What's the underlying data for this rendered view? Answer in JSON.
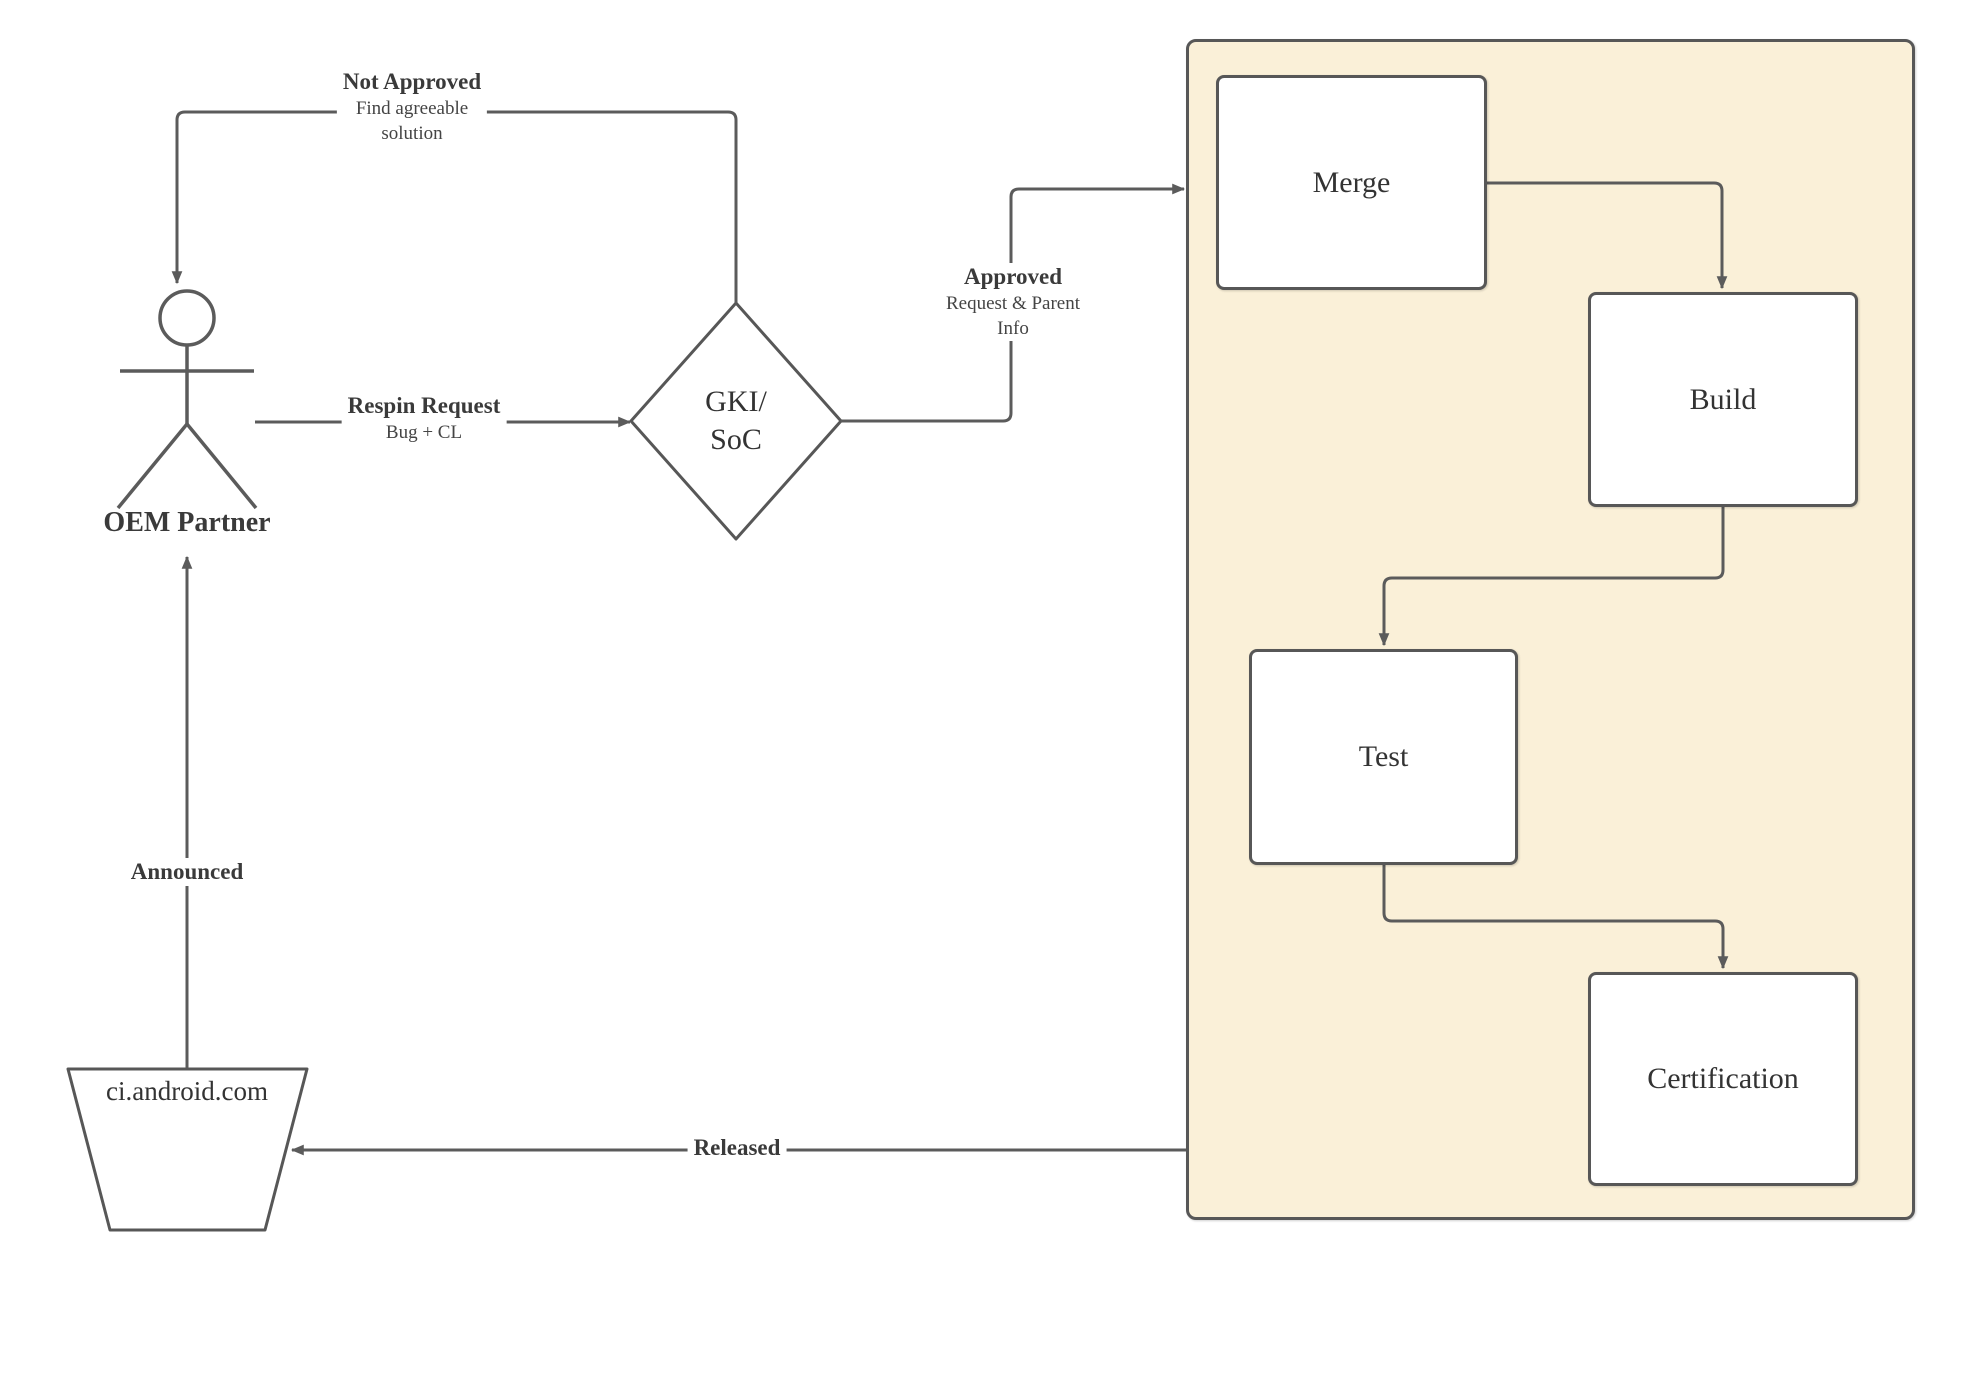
{
  "diagram": {
    "type": "flowchart",
    "background_color": "#ffffff",
    "line_color": "#5b5b5b",
    "text_color": "#363636",
    "actor": {
      "label": "OEM Partner"
    },
    "decision": {
      "line1": "GKI/",
      "line2": "SoC"
    },
    "datastore": {
      "label": "ci.android.com"
    },
    "container": {
      "fill_color": "#faf0d8",
      "border_color": "#575757",
      "nodes": {
        "merge": "Merge",
        "build": "Build",
        "test": "Test",
        "certification": "Certification"
      }
    },
    "edges": {
      "not_approved": {
        "title": "Not Approved",
        "sub1": "Find agreeable",
        "sub2": "solution"
      },
      "respin": {
        "title": "Respin Request",
        "sub": "Bug + CL"
      },
      "approved": {
        "title": "Approved",
        "sub1": "Request & Parent",
        "sub2": "Info"
      },
      "announced": {
        "title": "Announced"
      },
      "released": {
        "title": "Released"
      }
    }
  }
}
